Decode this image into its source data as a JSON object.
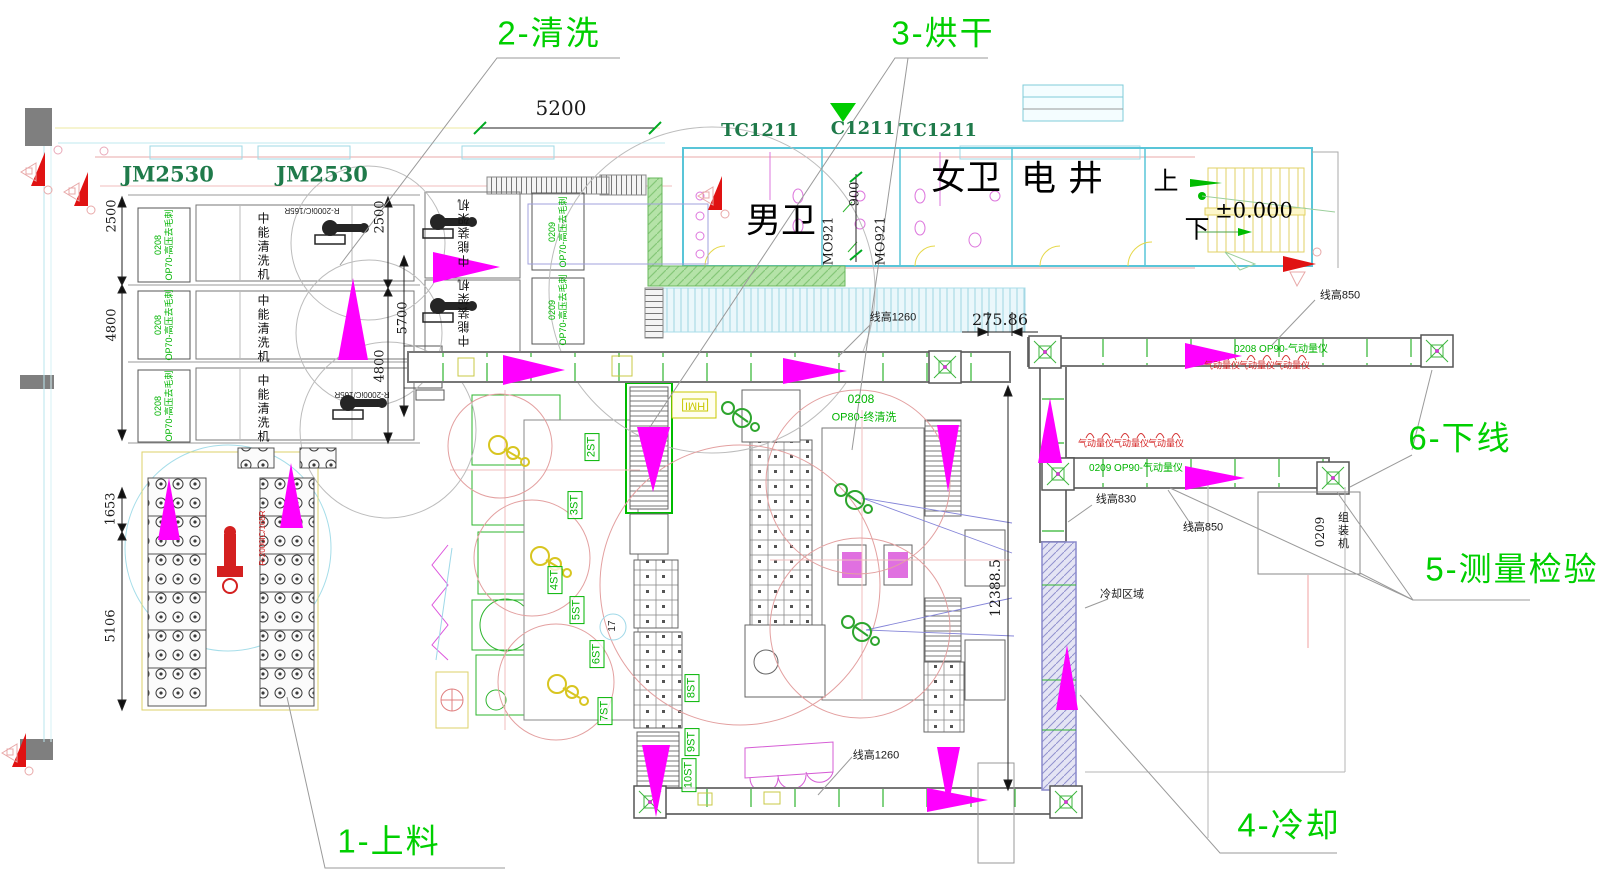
{
  "process_steps": {
    "step1": "1-上料",
    "step2": "2-清洗",
    "step3": "3-烘干",
    "step4": "4-冷却",
    "step5": "5-测量检验",
    "step6": "6-下线"
  },
  "cranes": {
    "jm2530": "JM2530",
    "tc1211": "TC1211",
    "c1211": "C1211"
  },
  "rooms": {
    "mens_wc": "男卫",
    "womens_wc": "女卫",
    "elec_shaft": "电井",
    "stairs_up": "上",
    "stairs_down": "下",
    "floor_level": "±0.000",
    "door_code": "MO921"
  },
  "dims": {
    "w5200": "5200",
    "w900": "900",
    "h2500": "2500",
    "h4800": "4800",
    "h5700": "5700",
    "h1653": "1653",
    "h5106": "5106",
    "gap": "275.86",
    "cooling_len": "12388.5"
  },
  "machines": {
    "washer_code": "0208",
    "washer_process": "OP70-高压去毛刺",
    "washer_name": "中能清洗机",
    "loader_code": "0209",
    "loader_process": "OP70-高压去毛刺",
    "loader_name": "中能装架机",
    "final_wash_code": "0208",
    "final_wash_process": "OP80-终清洗",
    "gauge_line1": "0208 OP90-气动量仪",
    "gauge_line2": "0209 OP90-气动量仪",
    "gauge": "气动量仪",
    "assembler_code": "0209",
    "assembler_name": "组装机",
    "robot_model": "R-2000iC/165R",
    "hmi": "HMI"
  },
  "notes": {
    "lh1260": "线高1260",
    "lh850": "线高850",
    "lh830": "线高830",
    "cooling_zone": "冷却区域"
  },
  "stations": {
    "st2": "2ST",
    "st3": "3ST",
    "st4": "4ST",
    "st5": "5ST",
    "st6": "6ST",
    "st7": "7ST",
    "st8": "8ST",
    "st9": "9ST",
    "st10": "10ST",
    "st17": "17"
  },
  "colors": {
    "annotation_green": "#00cf00",
    "equipment_green": "#00b400",
    "crane_green": "#1f7a4a",
    "flow_magenta": "#ff00ff",
    "alert_red": "#e01212",
    "wall_cyan": "#59c5d8",
    "fixture_magenta": "#dd77dd"
  }
}
